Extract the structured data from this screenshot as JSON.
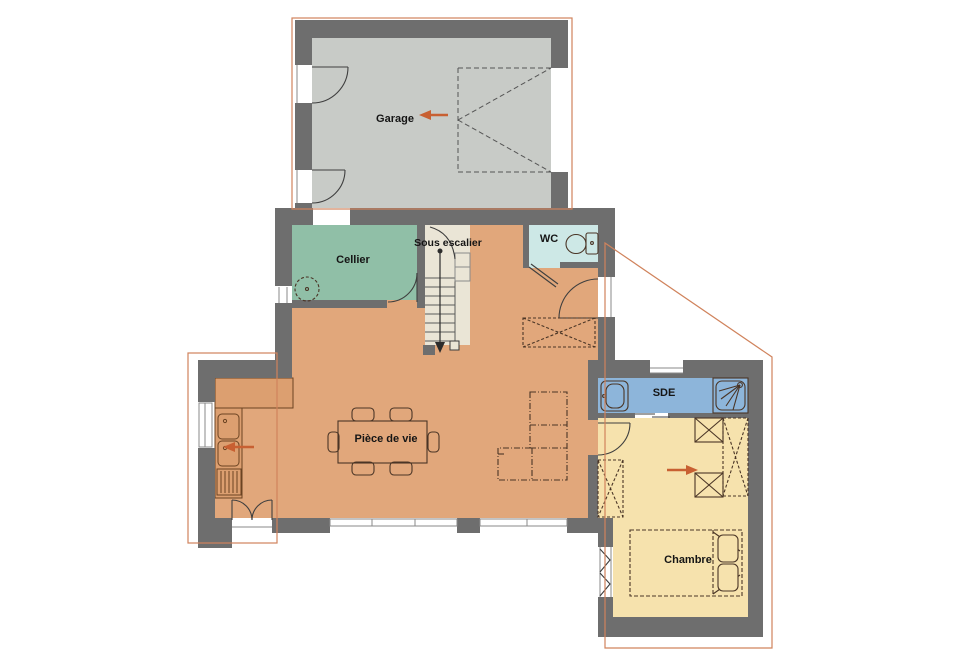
{
  "plan": {
    "rooms": {
      "garage": {
        "label": "Garage",
        "floor_color": "#c8cbc7"
      },
      "cellier": {
        "label": "Cellier",
        "floor_color": "#90bfa7"
      },
      "sous_escalier": {
        "label": "Sous escalier",
        "floor_color": "#eae5d6"
      },
      "wc": {
        "label": "WC",
        "floor_color": "#cde8e6"
      },
      "piece_de_vie": {
        "label": "Pièce de vie",
        "floor_color": "#e1a77b"
      },
      "sde": {
        "label": "SDE",
        "floor_color": "#8db5da"
      },
      "chambre": {
        "label": "Chambre",
        "floor_color": "#f6e2ad"
      }
    },
    "colors": {
      "wall": "#6e6e6e",
      "counter_fill": "#dc9f70",
      "counter_stroke": "#6b4322",
      "furniture_stroke": "#4a3526",
      "door_stroke": "#3f3f3f",
      "garage_door_stroke": "#555555",
      "arrow": "#c86032",
      "roof_line": "#d0835c",
      "background": "#ffffff"
    }
  }
}
